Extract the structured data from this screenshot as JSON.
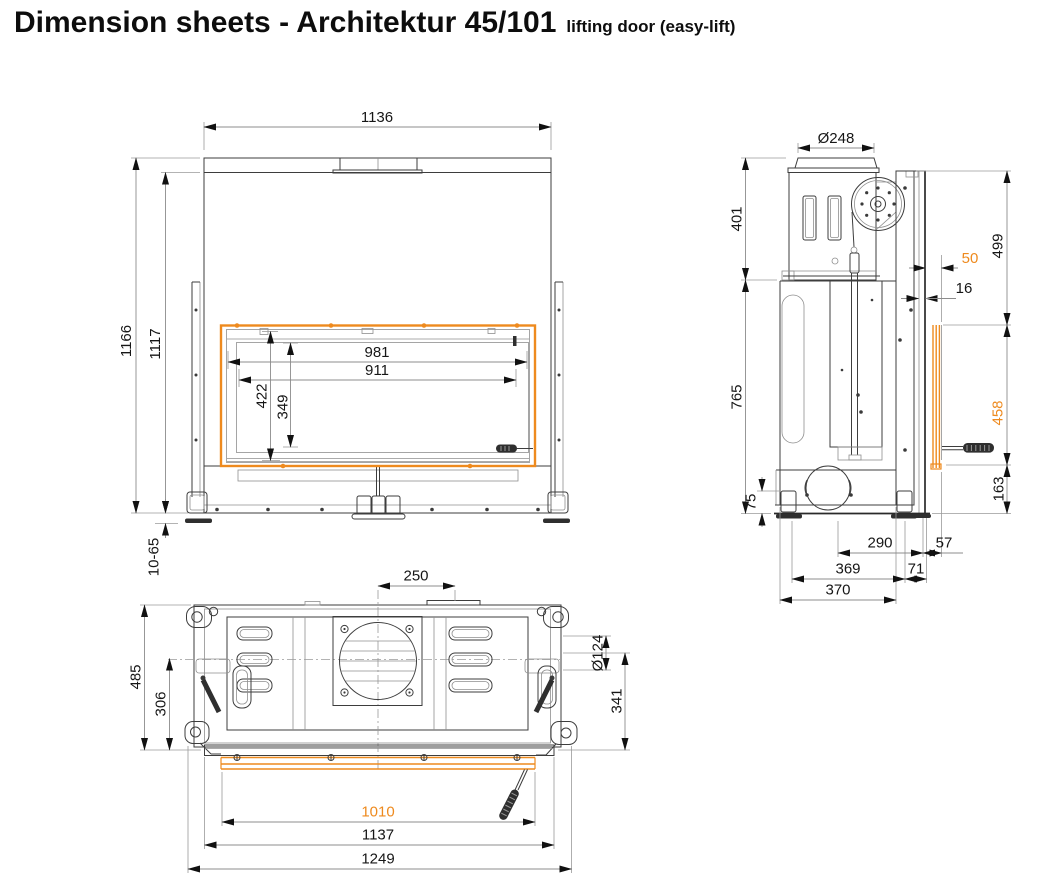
{
  "title": {
    "main": "Dimension sheets - Architektur 45/101",
    "suffix": "lifting door (easy-lift)"
  },
  "colors": {
    "accent_orange": "#EE8A1E",
    "drawing_line": "#3d3d3d",
    "dimension_text": "#161616"
  },
  "views": {
    "front": {
      "label": "front view",
      "dims": {
        "overall_width": "1136",
        "total_height": "1166",
        "body_height": "1117",
        "opening_width": "981",
        "glass_width": "911",
        "opening_height": "422",
        "glass_height": "349",
        "foot_adjustment": "10-65"
      }
    },
    "side": {
      "label": "side view",
      "dims": {
        "flue_diameter": "Ø248",
        "upper_section_height": "401",
        "front_offset": "50",
        "door_frame_height": "499",
        "rail_thickness": "16",
        "lower_section_height": "765",
        "glass_height": "458",
        "base_height": "163",
        "foot_height": "75",
        "depth_fan_to_rail": "290",
        "depth_rail_to_glass": "57",
        "depth_between_feet": "369",
        "rail_depth": "71",
        "overall_depth": "370"
      }
    },
    "top": {
      "label": "top view",
      "dims": {
        "flue_center_offset": "250",
        "overall_depth": "485",
        "latch_depth": "306",
        "port_diameter": "Ø124",
        "port_center_depth": "341",
        "glass_width": "1010",
        "door_width": "1137",
        "overall_width": "1249"
      }
    }
  }
}
